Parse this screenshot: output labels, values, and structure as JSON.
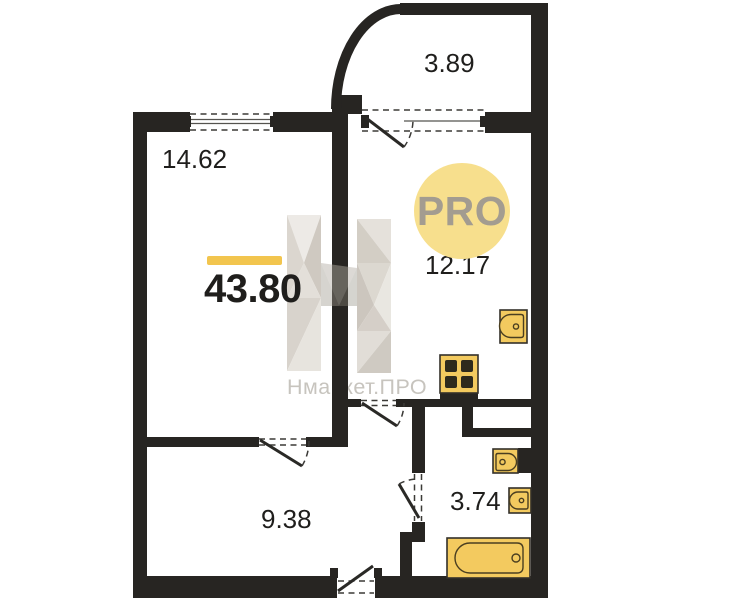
{
  "colors": {
    "wall": "#272522",
    "accent": "#f2c54e",
    "fixture": "#f3ca5f",
    "fixtureStroke": "#4a3e20",
    "burner": "#2e2a1c",
    "badgeBg": "#f7df8d",
    "badgeText": "#a39c90",
    "label": "#1f1e1c",
    "watermark": "#c7c4be"
  },
  "plan": {
    "total_area": "43.80",
    "badge_label": "PRO",
    "watermark_text": "Нмаркет.ПРО",
    "rooms": [
      {
        "name": "living-room",
        "area": "14.62"
      },
      {
        "name": "balcony",
        "area": "3.89"
      },
      {
        "name": "kitchen",
        "area": "12.17"
      },
      {
        "name": "hallway",
        "area": "9.38"
      },
      {
        "name": "bathroom",
        "area": "3.74"
      }
    ],
    "fixtures": [
      "stove-icon",
      "kitchen-sink-icon",
      "washbasin-icon",
      "toilet-icon",
      "bathtub-icon"
    ]
  }
}
